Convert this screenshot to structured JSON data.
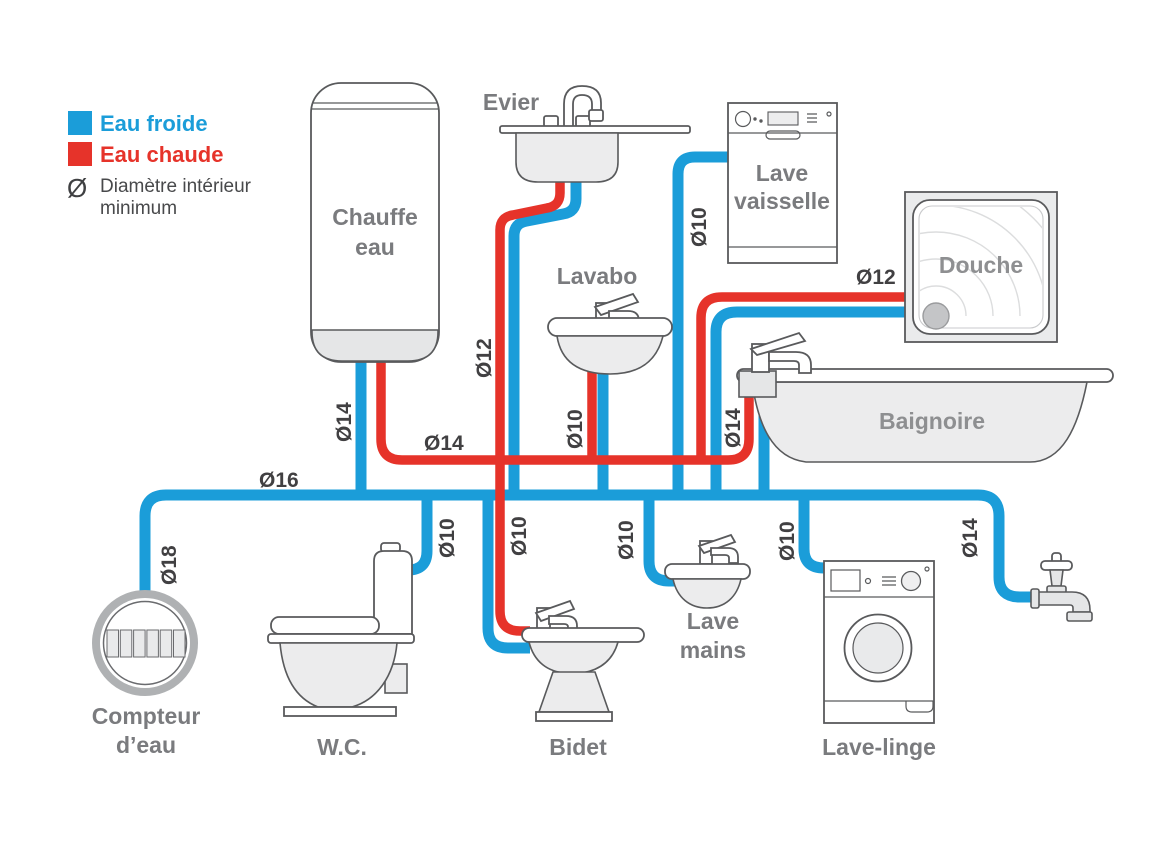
{
  "colors": {
    "cold_water": "#1B9DD9",
    "hot_water": "#E6332A",
    "fixture_stroke": "#595A5C",
    "label_gray": "#7A7B7E",
    "diameter_text": "#414042"
  },
  "legend": {
    "cold": {
      "label": "Eau froide",
      "color": "#1B9DD9"
    },
    "hot": {
      "label": "Eau chaude",
      "color": "#E6332A"
    },
    "diameter": {
      "symbol": "Ø",
      "note_line1": "Diamètre intérieur",
      "note_line2": "minimum"
    }
  },
  "fixtures": {
    "water_heater": {
      "line1": "Chauffe",
      "line2": "eau"
    },
    "kitchen_sink": {
      "label": "Evier"
    },
    "dishwasher": {
      "line1": "Lave",
      "line2": "vaisselle"
    },
    "shower": {
      "label": "Douche"
    },
    "washbasin": {
      "label": "Lavabo"
    },
    "bathtub": {
      "label": "Baignoire"
    },
    "hand_basin": {
      "line1": "Lave",
      "line2": "mains"
    },
    "water_meter": {
      "line1": "Compteur",
      "line2": "d’eau"
    },
    "toilet": {
      "label": "W.C."
    },
    "bidet": {
      "label": "Bidet"
    },
    "washing_machine": {
      "label": "Lave-linge"
    }
  },
  "pipe_labels": {
    "meter_riser": "Ø18",
    "cold_main": "Ø16",
    "heater_inlet": "Ø14",
    "hot_distribution": "Ø14",
    "sink_hot_riser": "Ø12",
    "washbasin_riser": "Ø10",
    "dishwasher_riser": "Ø10",
    "shower_pair": "Ø12",
    "bathtub_hot_riser": "Ø14",
    "toilet_branch": "Ø10",
    "bidet_branch": "Ø10",
    "hand_basin_branch": "Ø10",
    "washing_machine_branch": "Ø10",
    "garden_tap_branch": "Ø14"
  }
}
